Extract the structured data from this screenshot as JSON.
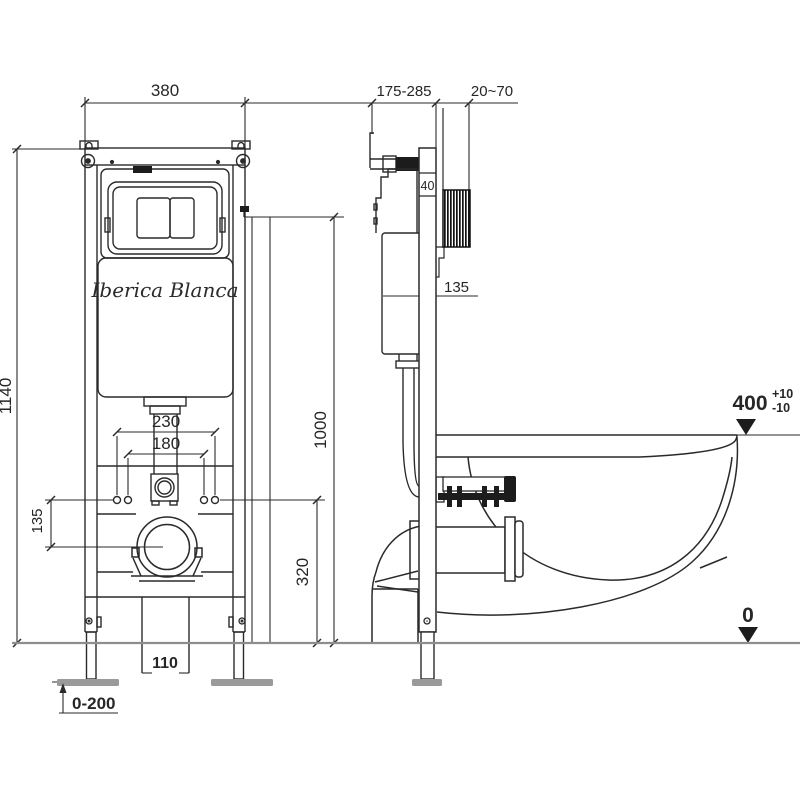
{
  "drawing": {
    "brand": "Iberica Blanca",
    "front": {
      "frame_width": "380",
      "frame_height": "1140",
      "bolt_spacing_outer": "230",
      "bolt_spacing_inner": "180",
      "outlet_offset": "135",
      "outlet_height": "320",
      "flush_center_height": "1000",
      "bottom_gap": "110",
      "foot_adjust_range": "0-200"
    },
    "side": {
      "depth_range": "175-285",
      "wall_thickness_range": "20~70",
      "rail_depth": "40",
      "inlet_offset": "135",
      "bowl_height": "400",
      "bowl_tol_plus": "+10",
      "bowl_tol_minus": "-10",
      "floor_level": "0"
    },
    "colors": {
      "line": "#2a2a2a",
      "floor_line": "#8e8e8e",
      "foot_plate": "#9a9a9a",
      "hatch": "#111111"
    }
  }
}
